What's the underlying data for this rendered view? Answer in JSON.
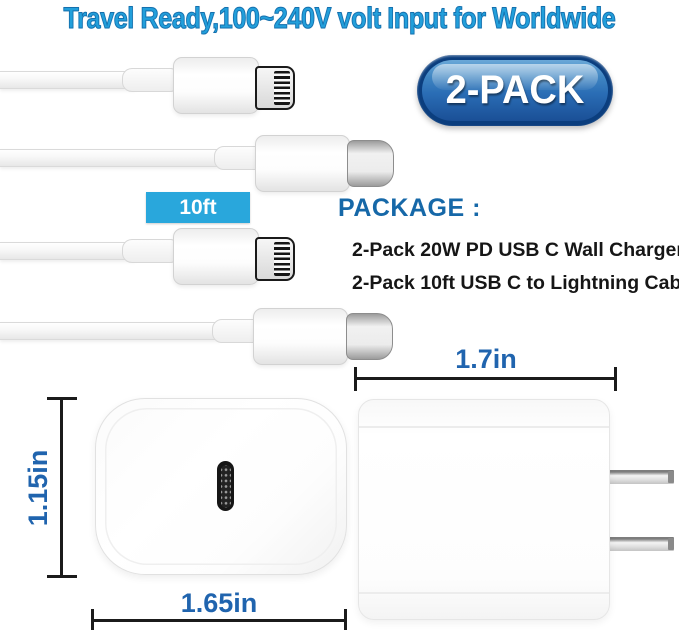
{
  "title": "Travel Ready,100~240V volt Input for Worldwide",
  "badge": {
    "label": "2-PACK"
  },
  "cable": {
    "length_label": "10ft"
  },
  "package": {
    "heading": "PACKAGE :",
    "items": [
      "2-Pack 20W PD USB C Wall Charger",
      "2-Pack 10ft USB C to Lightning Cables"
    ]
  },
  "dimensions": {
    "charger_side_width": "1.7in",
    "charger_front_height": "1.15in",
    "charger_front_width": "1.65in"
  },
  "figures": {
    "lightning_connector": "lightning-connector-icon",
    "usb_c_connector": "usb-c-connector-icon",
    "wall_charger_front": "wall-charger-front-image",
    "wall_charger_side": "wall-charger-side-image",
    "us_plug_prongs": "plug-prong-icon"
  },
  "colors": {
    "title_blue": "#22a0dc",
    "title_outline_blue": "#1470ae",
    "heading_blue": "#1668a8",
    "dimension_blue": "#2064ae",
    "cyan_label_bg": "#29a7dc",
    "badge_border_navy": "#0b3e7e",
    "badge_gradient_top": "#6aa8d8",
    "badge_gradient_bottom": "#1a4f96",
    "dimension_line_black": "#1b1b1b"
  }
}
